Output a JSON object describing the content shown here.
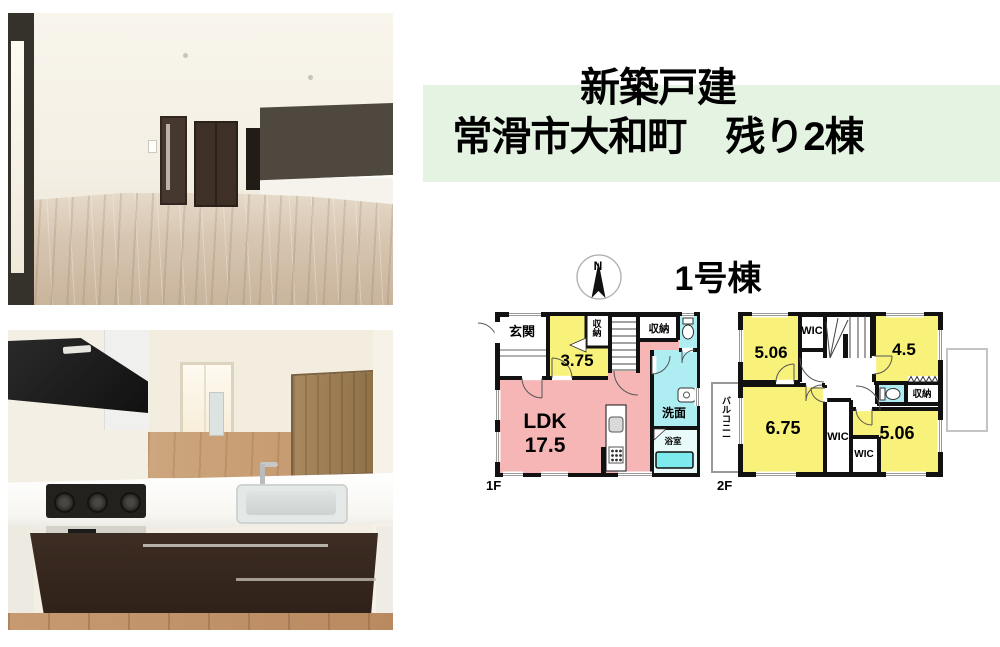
{
  "palette": {
    "banner_green": "#e5f3e2",
    "room_yellow": "#f8f27b",
    "room_pink": "#f6b6b6",
    "room_cyan": "#aeeef2",
    "bathtub_cyan": "#7deaee",
    "wall_black": "#111111"
  },
  "banner": {
    "line1": "新築戸建",
    "line2": "常滑市大和町　残り2棟"
  },
  "floorplan": {
    "building_name": "1号棟",
    "compass_n": "N",
    "floor1": {
      "floor_label": "1F",
      "entrance": "玄関",
      "room_3_75": "3.75",
      "closet_vertical": "収納",
      "closet_top": "収納",
      "ldk_name": "LDK",
      "ldk_size": "17.5",
      "washroom": "洗面",
      "bathroom": "浴室"
    },
    "floor2": {
      "floor_label": "2F",
      "bedroom_tl": "5.06",
      "wic_top": "WIC",
      "bedroom_tr": "4.5",
      "closet": "収納",
      "bedroom_bl": "6.75",
      "wic_mid": "WIC",
      "wic_small": "WIC",
      "bedroom_br": "5.06",
      "balcony": "バルコニー"
    }
  }
}
